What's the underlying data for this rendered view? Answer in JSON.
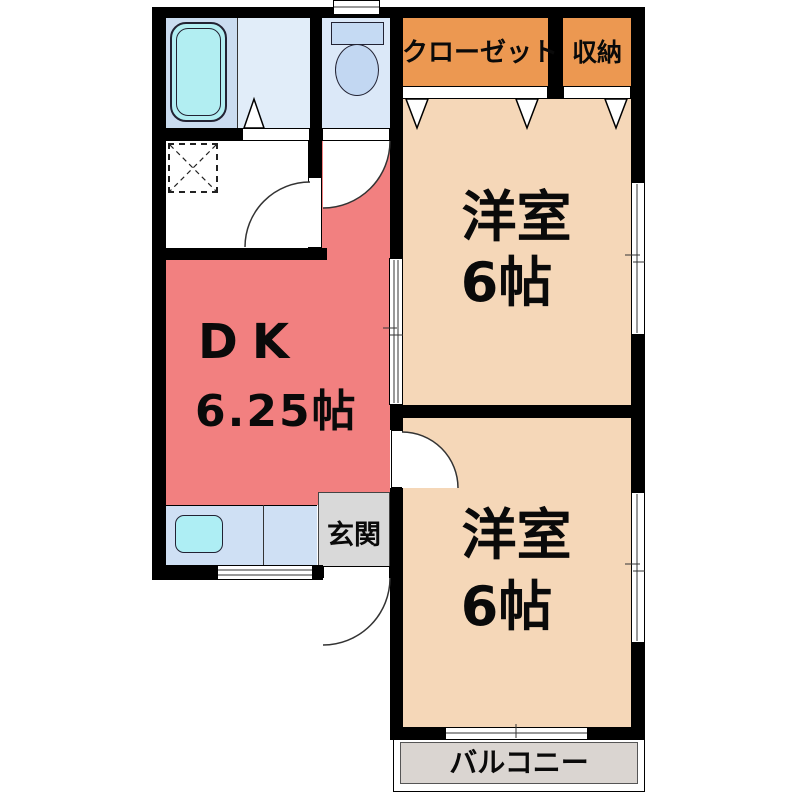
{
  "floor_plan": {
    "type": "apartment-floor-plan-2DK",
    "rooms": {
      "dk": {
        "name": "DK",
        "size": "6.25帖",
        "color": "#f28080"
      },
      "western_room_top": {
        "name": "洋室",
        "size": "6帖",
        "color": "#f5d7b8"
      },
      "western_room_bottom": {
        "name": "洋室",
        "size": "6帖",
        "color": "#f5d7b8"
      },
      "closet": {
        "name": "クローゼット",
        "color": "#ec9851"
      },
      "storage": {
        "name": "収納",
        "color": "#ec9851"
      },
      "entrance": {
        "name": "玄関",
        "color": "#d9d9d9"
      },
      "balcony": {
        "name": "バルコニー",
        "color": "#dad5d1"
      },
      "bathroom": {
        "color": "#cadcf0"
      },
      "bathroom_light": {
        "color": "#e1edf9"
      },
      "toilet_room": {
        "color": "#dbe8f8"
      },
      "washroom": {
        "color": "#ffffff"
      },
      "kitchen_counter": {
        "color": "#cfe0f4"
      }
    },
    "fixtures": [
      "bathtub",
      "toilet",
      "washing-machine-pan",
      "kitchen-sink"
    ],
    "colors": {
      "wall": "#000000",
      "fixture_cyan": "#b2eef2",
      "toilet_tank": "#c5daf3",
      "toilet_bowl": "#c2d7f2"
    }
  }
}
